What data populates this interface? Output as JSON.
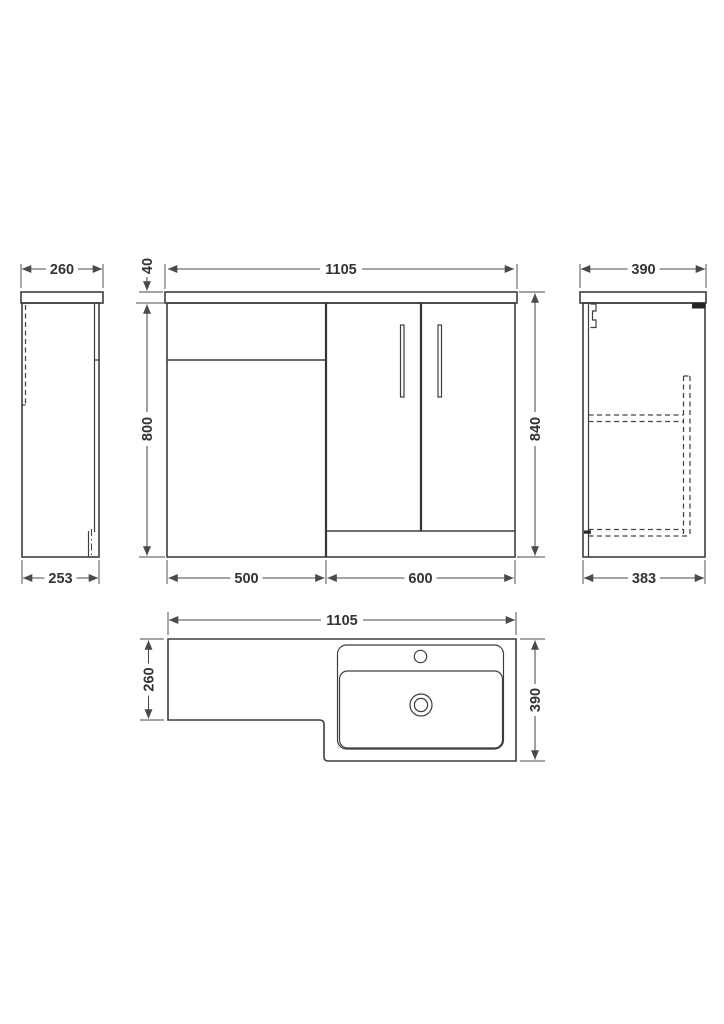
{
  "drawing": {
    "background_color": "#ffffff",
    "line_color": "#3d3d3d",
    "dimension_color": "#4a4a4a",
    "text_color": "#333333",
    "views": {
      "side_left": {
        "dim_top_width": "260",
        "dim_bottom_width": "253"
      },
      "front": {
        "dim_overall_width": "1105",
        "dim_worktop_thickness": "40",
        "dim_cabinet_height": "800",
        "dim_overall_height": "840",
        "dim_left_unit_width": "500",
        "dim_right_unit_width": "600"
      },
      "side_right": {
        "dim_top_depth": "390",
        "dim_bottom_depth": "383"
      },
      "plan": {
        "dim_overall_width": "1105",
        "dim_left_depth": "260",
        "dim_right_depth": "390"
      }
    }
  }
}
